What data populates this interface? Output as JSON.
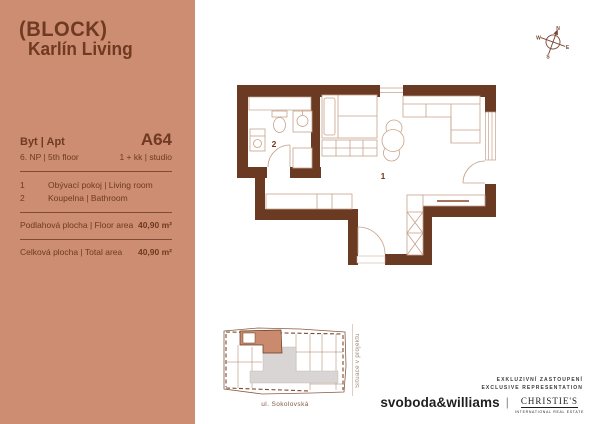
{
  "sidebar": {
    "logo_line1": "(BLOCK)",
    "logo_line2": "Karlín Living",
    "apt": {
      "label": "Byt | Apt",
      "number": "A64",
      "floor": "6. NP | 5th floor",
      "layout": "1 + kk |  studio"
    },
    "rooms": [
      {
        "num": "1",
        "label": "Obývací pokoj | Living room"
      },
      {
        "num": "2",
        "label": "Koupelna | Bathroom"
      }
    ],
    "floor_area": {
      "label": "Podlahová plocha | Floor area",
      "value": "40,90 m²"
    },
    "total_area": {
      "label": "Celková plocha | Total area",
      "value": "40,90 m²"
    }
  },
  "plan": {
    "room1_label": "1",
    "room2_label": "2"
  },
  "compass": {
    "n": "N",
    "e": "E",
    "s": "S",
    "w": "W"
  },
  "siteplan": {
    "street": "ul. Sokolovská",
    "caption": "Situace v projektu"
  },
  "footer": {
    "rep_line1": "EXKLUZIVNÍ ZASTOUPENÍ",
    "rep_line2": "EXCLUSIVE REPRESENTATION",
    "brand1": "svoboda&williams",
    "separator": "|",
    "brand2": "CHRISTIE'S",
    "brand2_sub": "INTERNATIONAL REAL ESTATE"
  },
  "colors": {
    "sidebar_bg": "#CC8D72",
    "wall_brown": "#6B3A22",
    "text_brown": "#6F3A21",
    "furniture_line": "#C7A28B",
    "highlight_unit": "#CA8A6D",
    "corridor_gray": "#D8D5D4"
  }
}
